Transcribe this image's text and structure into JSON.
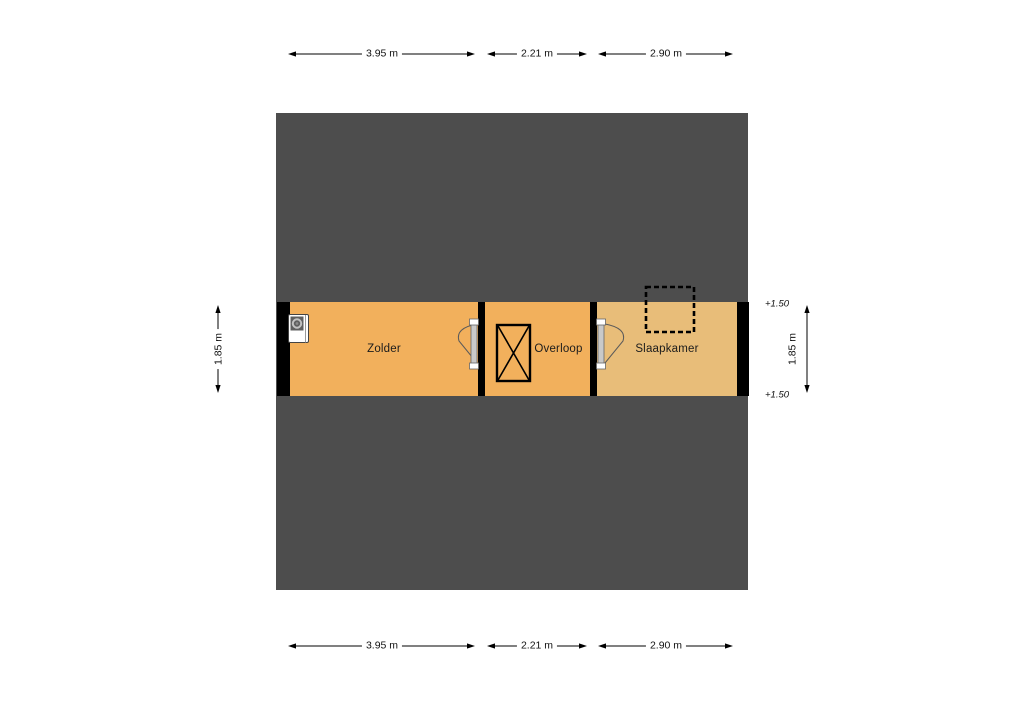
{
  "floorplan": {
    "title": "attic floor plan",
    "colors": {
      "background": "#ffffff",
      "roof_fill": "#4d4d4d",
      "wall_fill": "#000000",
      "room_fill_attic": "#f2b05c",
      "room_fill_bedroom": "#e8bd79",
      "door_leaf_fill": "#c9c9c9"
    },
    "rooms": [
      {
        "name": "zolder",
        "label": "Zolder",
        "fill": "#f2b05c"
      },
      {
        "name": "overloop",
        "label": "Overloop",
        "fill": "#f2b05c"
      },
      {
        "name": "slaapkamer",
        "label": "Slaapkamer",
        "fill": "#e8bd79"
      }
    ],
    "dimensions": {
      "top": [
        {
          "label": "3.95 m"
        },
        {
          "label": "2.21 m"
        },
        {
          "label": "2.90 m"
        }
      ],
      "bottom": [
        {
          "label": "3.95 m"
        },
        {
          "label": "2.21 m"
        },
        {
          "label": "2.90 m"
        }
      ],
      "left": {
        "label": "1.85 m"
      },
      "right": {
        "label": "1.85 m"
      }
    },
    "level_markers": [
      {
        "label": "+1.50"
      },
      {
        "label": "+1.50"
      }
    ],
    "icons": [
      {
        "name": "stairs-icon",
        "shape": "rectangle with X cross"
      },
      {
        "name": "boiler-icon",
        "shape": "white unit with drum circle"
      },
      {
        "name": "dormer-outline-icon",
        "shape": "dashed rectangle"
      },
      {
        "name": "door-swing-icon",
        "shape": "door leaf with swing wedge"
      }
    ]
  }
}
